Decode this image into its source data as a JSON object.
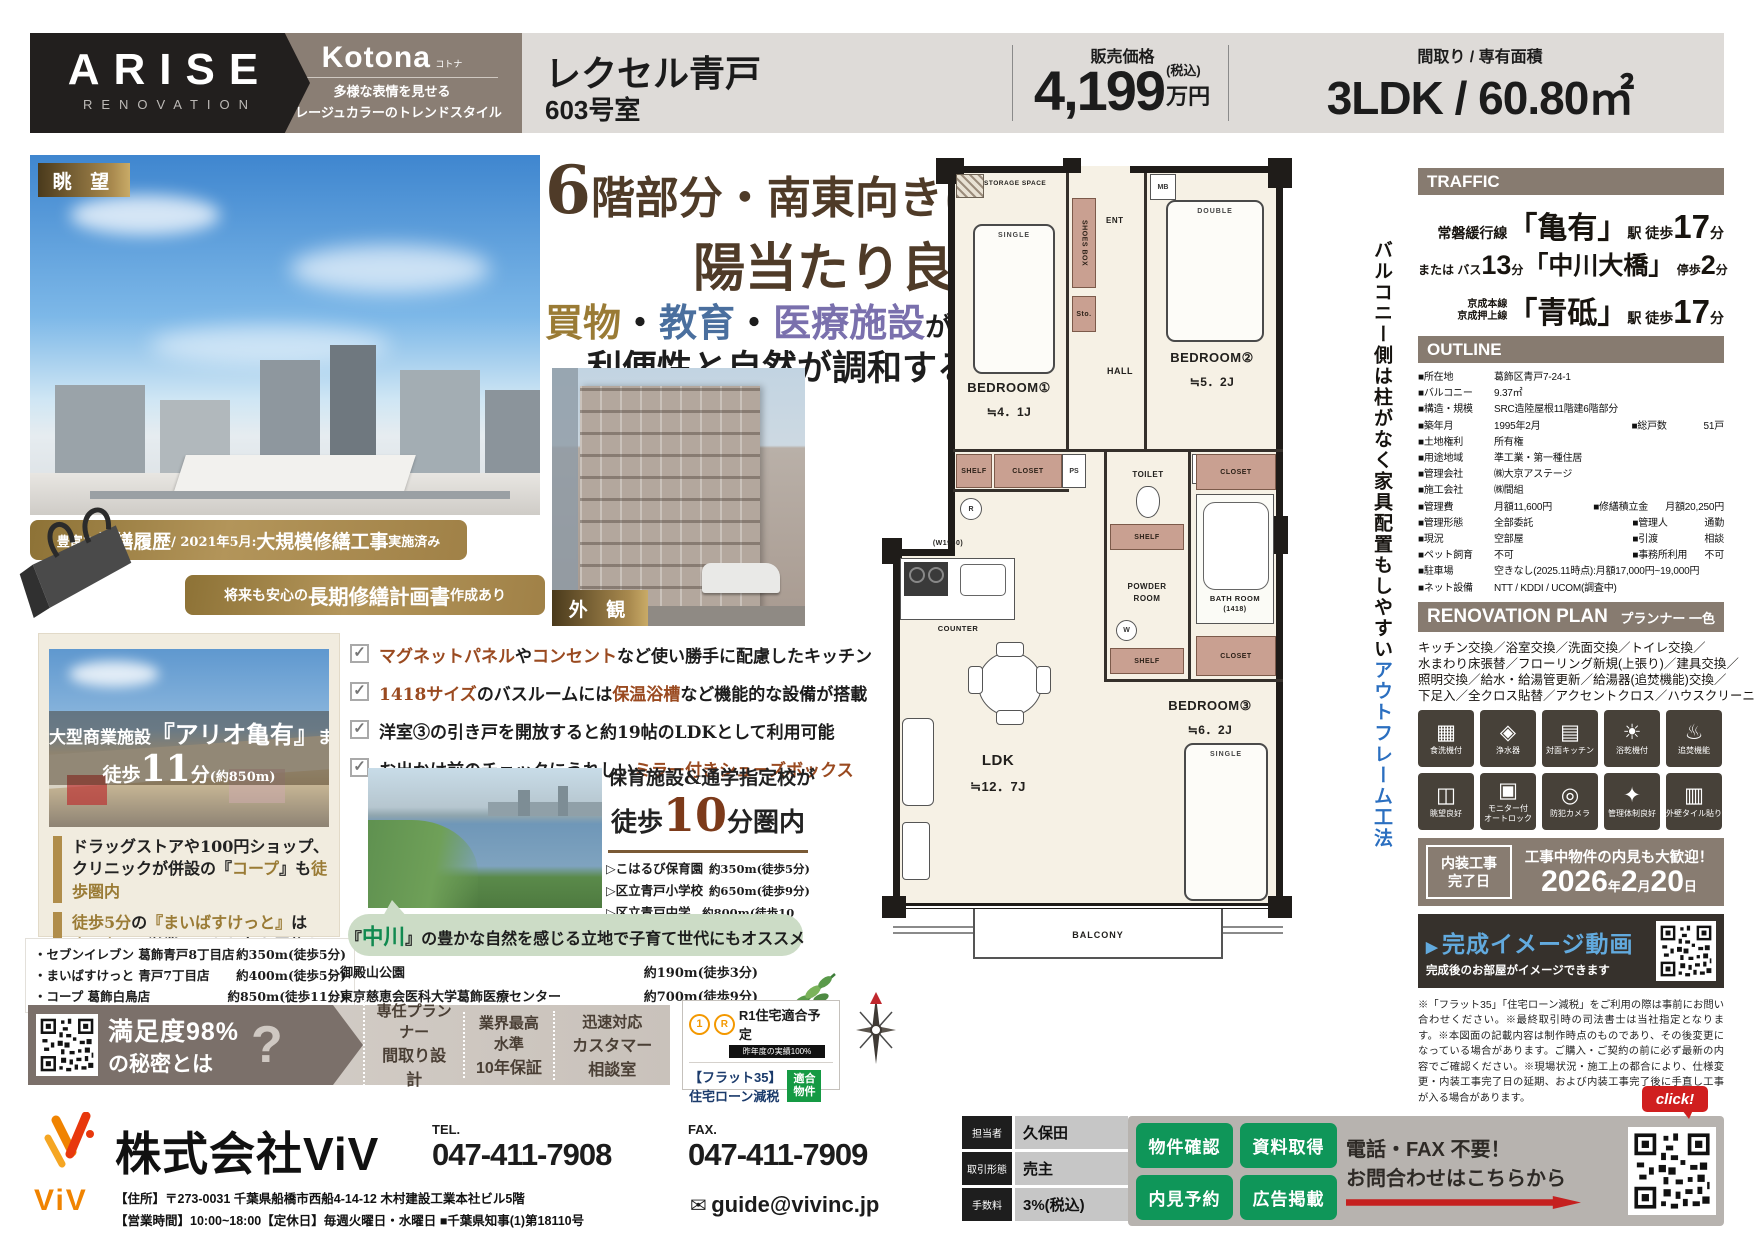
{
  "colors": {
    "taupe": "#877b70",
    "gold": "#a98c50",
    "accent_brown": "#4f3b28",
    "green": "#0f9659",
    "blue_accent": "#2b6fc0",
    "red": "#c5201f"
  },
  "header": {
    "logo_line1": "ARISE",
    "logo_line2": "RENOVATION",
    "brand": "Kotona",
    "brand_kana": "コトナ",
    "brand_sub1": "多様な表情を見せる",
    "brand_sub2": "グレージュカラーのトレンドスタイル",
    "property_name": "レクセル青戸",
    "room": "603号室",
    "price_label": "販売価格",
    "price_value": "4,199",
    "price_tax": "(税込)",
    "price_unit": "万円",
    "plan_label": "間取り / 専有面積",
    "plan_value": "3LDK / 60.80㎡"
  },
  "hero": {
    "tag_view": "眺 望",
    "tag_exterior": "外 観",
    "h1_parts": [
      {
        "t": "6",
        "c": "h1big"
      },
      {
        "t": "階部分・南東向きにつき"
      }
    ],
    "h2": "陽当たり良好",
    "h3_parts": [
      {
        "t": "買物",
        "c": "gold"
      },
      {
        "t": "・"
      },
      {
        "t": "教育",
        "c": "blue"
      },
      {
        "t": "・"
      },
      {
        "t": "医療施設",
        "c": "purple"
      },
      {
        "t": "が",
        "c": "sm"
      },
      {
        "t": "徒歩圏内",
        "c": "brown"
      }
    ],
    "h4": "利便性と自然が調和する街",
    "banner1_parts": [
      {
        "t": "豊富な"
      },
      {
        "t": "修繕履歴",
        "c": "big"
      },
      {
        "t": " / 2021年5月:"
      },
      {
        "t": "大規模修繕工事",
        "c": "big"
      },
      {
        "t": "実施済み"
      }
    ],
    "banner2_parts": [
      {
        "t": "将来も安心の"
      },
      {
        "t": "長期修繕計画書",
        "c": "big"
      },
      {
        "t": "作成あり"
      }
    ]
  },
  "shopping": {
    "card_line1_parts": [
      {
        "t": "大型商業施設"
      },
      {
        "t": "『アリオ亀有』",
        "c": "cb"
      },
      {
        "t": "まで"
      }
    ],
    "card_line2_parts": [
      {
        "t": "徒歩"
      },
      {
        "t": "11",
        "c": "c11"
      },
      {
        "t": "分"
      },
      {
        "t": "(約850m)",
        "c": "csm"
      }
    ],
    "bullets": [
      {
        "parts": [
          {
            "t": "ドラッグストアや100円ショップ、"
          },
          {
            "br": true
          },
          {
            "t": "クリニックが併設の『"
          },
          {
            "t": "コープ",
            "c": "gold"
          },
          {
            "t": "』も"
          },
          {
            "t": "徒歩圏内",
            "c": "gold"
          }
        ]
      },
      {
        "parts": [
          {
            "t": "徒歩5分",
            "c": "gold"
          },
          {
            "t": "の"
          },
          {
            "t": "『まいばすけっと』",
            "c": "gold"
          },
          {
            "t": "は"
          },
          {
            "br": true
          },
          {
            "t": "夜0時",
            "c": "gold"
          },
          {
            "t": "まで営業しており急な買物も便利"
          }
        ]
      }
    ],
    "stores": [
      {
        "name": "・セブンイレブン 葛飾青戸8丁目店",
        "dist": "約350m(徒歩5分)"
      },
      {
        "name": "・まいばすけっと 青戸7丁目店",
        "dist": "約400m(徒歩5分)"
      },
      {
        "name": "・コープ 葛飾白鳥店",
        "dist": "約850m(徒歩11分)"
      }
    ]
  },
  "features": {
    "items": [
      {
        "parts": [
          {
            "t": "マグネットパネル",
            "c": "em"
          },
          {
            "t": "や"
          },
          {
            "t": "コンセント",
            "c": "em"
          },
          {
            "t": "など使い勝手に配慮したキッチン"
          }
        ]
      },
      {
        "parts": [
          {
            "t": "1418サイズ",
            "c": "em"
          },
          {
            "t": "のバスルームには"
          },
          {
            "t": "保温浴槽",
            "c": "em"
          },
          {
            "t": "など機能的な設備が搭載"
          }
        ]
      },
      {
        "parts": [
          {
            "t": "洋室③の引き戸を開放すると約19帖のLDKとして利用可能"
          }
        ]
      },
      {
        "parts": [
          {
            "t": "お出かけ前のチェックにうれしい"
          },
          {
            "t": "ミラー付きシューズボックス",
            "c": "em"
          }
        ]
      }
    ]
  },
  "education": {
    "title": "保育施設&通学指定校が",
    "walk_parts": [
      {
        "t": "徒歩",
        "c": "wm"
      },
      {
        "t": "10",
        "c": "whuge"
      },
      {
        "t": "分圏内",
        "c": "wm"
      }
    ],
    "schools": [
      {
        "name": "▷こはるび保育園",
        "dist": "約350m(徒歩5分)"
      },
      {
        "name": "▷区立青戸小学校",
        "dist": "約650m(徒歩9分)"
      },
      {
        "name": "▷区立青戸中学校",
        "dist": "約800m(徒歩10分)"
      }
    ]
  },
  "nature": {
    "bubble_parts": [
      {
        "t": "『"
      },
      {
        "t": "中川",
        "c": "green"
      },
      {
        "t": "』の豊かな自然を感じる立地で子育て世代にもオススメ"
      }
    ],
    "spots": [
      {
        "name": "▷御殿山公園",
        "dist": "約190m(徒歩3分)"
      },
      {
        "name": "▷東京慈恵会医科大学葛飾医療センター",
        "dist": "約700m(徒歩9分)"
      }
    ]
  },
  "badges": {
    "sat_line1": "満足度98%",
    "sat_line2": "の秘密とは",
    "q": "?",
    "points": [
      {
        "l1": "専任プランナー",
        "l2": "間取り設計"
      },
      {
        "l1": "業界最高水準",
        "l2": "10年保証"
      },
      {
        "l1": "迅速対応",
        "l2": "カスタマー相談室"
      }
    ],
    "r1_mark1": "1",
    "r1_mark2": "R",
    "r1_title": "R1住宅適合予定",
    "r1_sub": "昨年度の実績100%",
    "flat35_1": "【フラット35】",
    "flat35_2": "住宅ローン減税",
    "fit1": "適合",
    "fit2": "物件"
  },
  "floorplan": {
    "storage": "STORAGE SPACE",
    "mb": "MB",
    "shoes": "SHOES BOX",
    "ent": "ENT",
    "sto": "Sto.",
    "single": "SINGLE",
    "double": "DOUBLE",
    "br1": "BEDROOM①",
    "br1_size": "≒4．1J",
    "br2": "BEDROOM②",
    "br2_size": "≒5．2J",
    "br3": "BEDROOM③",
    "br3_size": "≒6．2J",
    "hall": "HALL",
    "shelf": "SHELF",
    "closet": "CLOSET",
    "ps": "PS",
    "r": "R",
    "w": "W",
    "toilet": "TOILET",
    "bath": "BATH ROOM",
    "bath_size": "(1418)",
    "powder1": "POWDER",
    "powder2": "ROOM",
    "w1950": "(W1950)",
    "counter": "COUNTER",
    "ldk": "LDK",
    "ldk_size": "≒12．7J",
    "balcony": "BALCONY",
    "side_black": "バルコニー側は柱がなく家具配置もしやすい",
    "side_blue": "アウトフレーム工法"
  },
  "traffic": {
    "header": "TRAFFIC",
    "l1_parts": [
      {
        "t": "常磐緩行線",
        "c": "s"
      },
      {
        "t": "「亀有」",
        "c": "b"
      },
      {
        "t": "駅 徒歩",
        "c": "s"
      },
      {
        "t": "17",
        "c": "n"
      },
      {
        "t": "分",
        "c": "s"
      }
    ],
    "l2_parts": [
      {
        "t": "または バス",
        "c": "xs"
      },
      {
        "t": "13",
        "c": "n2"
      },
      {
        "t": "分",
        "c": "xs"
      },
      {
        "t": "「中川大橋」",
        "c": "b2"
      },
      {
        "t": " 停歩",
        "c": "xs"
      },
      {
        "t": "2",
        "c": "n2"
      },
      {
        "t": "分",
        "c": "xs"
      }
    ],
    "l3_parts": [
      {
        "t": "京成本線\n京成押上線",
        "c": "stack"
      },
      {
        "t": "「青砥」",
        "c": "b"
      },
      {
        "t": "駅 徒歩",
        "c": "s"
      },
      {
        "t": "17",
        "c": "n"
      },
      {
        "t": "分",
        "c": "s"
      }
    ]
  },
  "outline": {
    "header": "OUTLINE",
    "rows": [
      {
        "l": "■所在地",
        "v": "葛飾区青戸7-24-1"
      },
      {
        "l": "■バルコニー",
        "v": "9.37㎡"
      },
      {
        "l": "■構造・規模",
        "v": "SRC造陸屋根11階建6階部分"
      },
      {
        "l": "■築年月",
        "v": "1995年2月",
        "l2": "■総戸数",
        "v2": "51戸"
      },
      {
        "l": "■土地権利",
        "v": "所有権"
      },
      {
        "l": "■用途地域",
        "v": "準工業・第一種住居"
      },
      {
        "l": "■管理会社",
        "v": "㈱大京アステージ"
      },
      {
        "l": "■施工会社",
        "v": "㈱間組"
      },
      {
        "l": "■管理費",
        "v": "月額11,600円",
        "l2": "■修繕積立金",
        "v2": "月額20,250円"
      },
      {
        "l": "■管理形態",
        "v": "全部委託",
        "l2": "■管理人",
        "v2": "通勤"
      },
      {
        "l": "■現況",
        "v": "空部屋",
        "l2": "■引渡",
        "v2": "相談"
      },
      {
        "l": "■ペット飼育",
        "v": "不可",
        "l2": "■事務所利用",
        "v2": "不可"
      },
      {
        "l": "■駐車場",
        "v": "空きなし(2025.11時点):月額17,000円~19,000円"
      },
      {
        "l": "■ネット設備",
        "v": "NTT / KDDI / UCOM(調査中)"
      }
    ]
  },
  "renovation": {
    "header": "RENOVATION PLAN",
    "planner": "プランナー 一色",
    "lines": [
      {
        "t": "キッチン交換／浴室交換／洗面交換／トイレ交換／"
      },
      {
        "t": "水まわり床張替／フローリング新規(上張り)／建具交換／"
      },
      {
        "t": "照明交換／給水・給湯管更新／給湯器(追焚機能)交換／"
      },
      {
        "t": "下足入／全クロス貼替／アクセントクロス／ハウスクリーニング"
      }
    ],
    "icons": [
      {
        "name": "dishwasher-icon",
        "glyph": "▦",
        "label": "食洗機付"
      },
      {
        "name": "water-purifier-icon",
        "glyph": "◈",
        "label": "浄水器"
      },
      {
        "name": "counter-kitchen-icon",
        "glyph": "▤",
        "label": "対面キッチン"
      },
      {
        "name": "bath-dryer-icon",
        "glyph": "☀",
        "label": "浴乾機付"
      },
      {
        "name": "reheat-bath-icon",
        "glyph": "♨",
        "label": "追焚機能"
      },
      {
        "name": "good-view-icon",
        "glyph": "◫",
        "label": "眺望良好"
      },
      {
        "name": "monitor-autolock-icon",
        "glyph": "▣",
        "label": "モニター付\nオートロック"
      },
      {
        "name": "security-camera-icon",
        "glyph": "◎",
        "label": "防犯カメラ"
      },
      {
        "name": "management-icon",
        "glyph": "✦",
        "label": "管理体制良好"
      },
      {
        "name": "tile-wall-icon",
        "glyph": "▥",
        "label": "外壁タイル貼り"
      }
    ]
  },
  "completion": {
    "box_label": "内装工事\n完了日",
    "headline": "工事中物件の内見も大歓迎！",
    "date_parts": [
      {
        "t": "2026",
        "c": "dn"
      },
      {
        "t": "年",
        "c": "ds"
      },
      {
        "t": "2",
        "c": "dn"
      },
      {
        "t": "月",
        "c": "ds"
      },
      {
        "t": "20",
        "c": "dn"
      },
      {
        "t": "日",
        "c": "ds"
      }
    ]
  },
  "video": {
    "mark": "▶",
    "title": "完成イメージ動画",
    "sub": "完成後のお部屋がイメージできます"
  },
  "disclaimer": "※「フラット35」「住宅ローン減税」をご利用の際は事前にお問い合わせください。※最終取引時の司法書士は当社指定となります。※本図面の記載内容は制作時点のものであり、その後変更になっている場合があります。ご購入・ご契約の前に必ず最新の内容でご確認ください。※現場状況・施工上の都合により、仕様変更・内装工事完了日の延期、および内装工事完了後に手直し工事が入る場合があります。",
  "footer": {
    "logo_text": "ViV",
    "company": "株式会社ViV",
    "tel_label": "TEL.",
    "tel": "047-411-7908",
    "fax_label": "FAX.",
    "fax": "047-411-7909",
    "address": "【住所】〒273-0031 千葉県船橋市西船4-14-12 木村建設工業本社ビル5階",
    "hours": "【営業時間】10:00~18:00【定休日】毎週火曜日・水曜日 ■千葉県知事(1)第18110号",
    "email_icon": "✉",
    "email": "guide@vivinc.jp",
    "staff": [
      {
        "l": "担当者",
        "v": "久保田"
      },
      {
        "l": "取引形態",
        "v": "売主"
      },
      {
        "l": "手数料",
        "v": "3%(税込)"
      }
    ],
    "buttons": [
      {
        "label": "物件確認"
      },
      {
        "label": "資料取得"
      },
      {
        "label": "内見予約"
      },
      {
        "label": "広告掲載"
      }
    ],
    "cta1": "電話・FAX 不要！",
    "cta2": "お問合わせはこちらから",
    "click": "click!"
  }
}
